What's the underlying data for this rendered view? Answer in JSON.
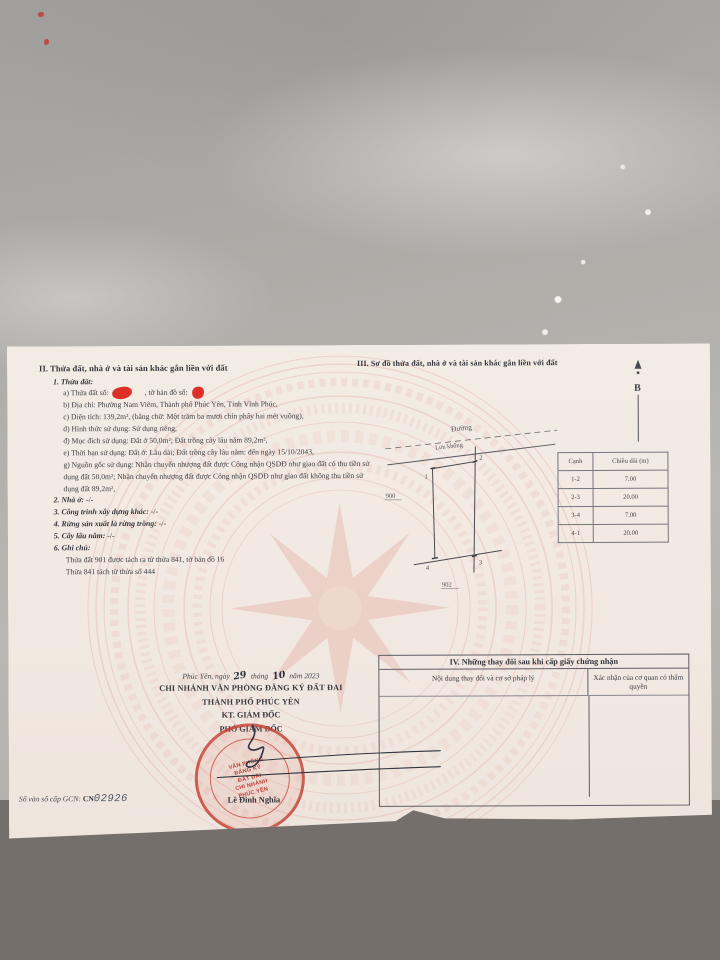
{
  "doc": {
    "section2": {
      "heading": "II. Thửa đất, nhà ở và tài sản khác gắn liền với đất",
      "sub1": "1. Thửa đất:",
      "line_a_prefix": "a) Thửa đất số:",
      "line_a_middle": ", tờ bản đồ số:",
      "line_b": "b) Địa chỉ: Phường Nam Viêm, Thành phố Phúc Yên, Tỉnh Vĩnh Phúc,",
      "line_c": "c) Diện tích: 139,2m², (bằng chữ: Một trăm ba mươi chín phẩy hai mét vuông),",
      "line_d": "d) Hình thức sử dụng: Sử dụng riêng,",
      "line_dd": "đ) Mục đích sử dụng: Đất ở 50,0m²; Đất trồng cây lâu năm 89,2m²,",
      "line_e": "e) Thời hạn sử dụng: Đất ở: Lâu dài; Đất trồng cây lâu năm: đến ngày 15/10/2043,",
      "line_g": "g) Nguồn gốc sử dụng: Nhận chuyển nhượng đất được Công nhận QSDĐ như giao đất có thu tiền sử dụng đất 50,0m²; Nhận chuyển nhượng đất được Công nhận QSDĐ như giao đất không thu tiền sử dụng đất 89,2m²,",
      "item2_label": "2. Nhà ở:",
      "item2_value": "-/-",
      "item3_label": "3. Công trình xây dựng khác:",
      "item3_value": "-/-",
      "item4_label": "4. Rừng sản xuất là rừng trồng:",
      "item4_value": "-/-",
      "item5_label": "5. Cây lâu năm:",
      "item5_value": "-/-",
      "item6_label": "6. Ghi chú:",
      "note1": "Thửa đất 901 được tách ra từ thửa 841, tờ bản đồ 16",
      "note2": "Thửa 841 tách từ thửa số 444"
    },
    "section3": {
      "heading": "III. Sơ đồ thửa đất, nhà ở và tài sản khác gắn liền với đất",
      "north_label": "B",
      "road_label": "Đường",
      "buffer_label": "Lưu không",
      "corner1": "1",
      "corner2": "2",
      "corner3": "3",
      "corner4": "4",
      "left_parcel": "900",
      "bottom_parcel": "902"
    },
    "edge_table": {
      "col_edge": "Cạnh",
      "col_length": "Chiều dài (m)",
      "rows": [
        {
          "edge": "1-2",
          "length": "7.00"
        },
        {
          "edge": "2-3",
          "length": "20.00"
        },
        {
          "edge": "3-4",
          "length": "7.00"
        },
        {
          "edge": "4-1",
          "length": "20.00"
        }
      ]
    },
    "section4": {
      "heading": "IV. Những thay đổi sau khi cấp giấy chứng nhận",
      "col1": "Nội dung thay đổi và cơ sở pháp lý",
      "col2": "Xác nhận của cơ quan có thẩm quyền"
    },
    "signature": {
      "date_prefix": "Phúc Yên, ngày",
      "date_day": "29",
      "date_middle": "tháng",
      "date_month": "10",
      "date_suffix": "năm 2023",
      "org_line1": "CHI NHÁNH VĂN PHÒNG ĐĂNG KÝ ĐẤT ĐAI",
      "org_line2": "THÀNH PHỐ PHÚC YÊN",
      "role_line1": "KT. GIÁM ĐỐC",
      "role_line2": "PHÓ GIÁM ĐỐC",
      "signer_name": "Lê Đình Nghĩa",
      "stamp_lines": [
        "VĂN PHÒNG",
        "ĐĂNG KÝ",
        "ĐẤT ĐAI",
        "CHI NHÁNH",
        "PHÚC YÊN"
      ]
    },
    "footer": {
      "serial_prefix": "Số vào sổ cấp GCN: ",
      "serial_code": "CN",
      "serial_number": "02926"
    },
    "colors": {
      "stamp_red": "#c03a2c",
      "redaction_red": "#dd2f26",
      "emblem_pink": "#e3b4aa",
      "paper": "#f2ebe4"
    }
  }
}
